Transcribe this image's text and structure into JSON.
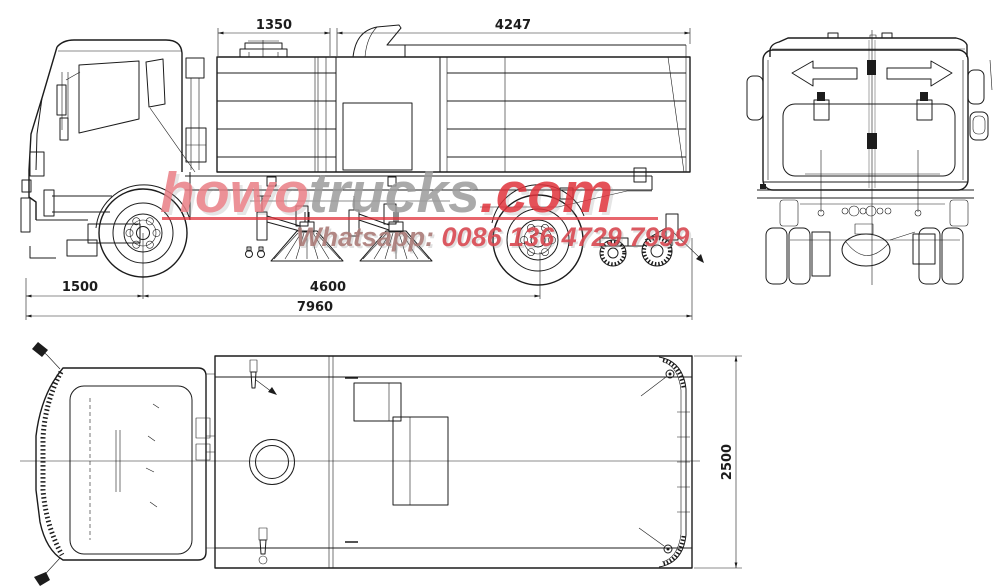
{
  "canvas": {
    "bg": "#ffffff",
    "ink": "#1c1c1c"
  },
  "dimensions": {
    "top_left_span": "1350",
    "top_right_span": "4247",
    "front_overhang": "1500",
    "wheelbase": "4600",
    "overall_length": "7960",
    "overall_width": "2500"
  },
  "watermark": {
    "brand_red": "howo",
    "brand_gray": "trucks",
    "brand_suffix": ".com",
    "contact_label": "Whatsapp:",
    "contact_number": "0086 136 4729 7999",
    "accent_red": "#e0333c",
    "accent_gray": "#9c9c9c"
  }
}
